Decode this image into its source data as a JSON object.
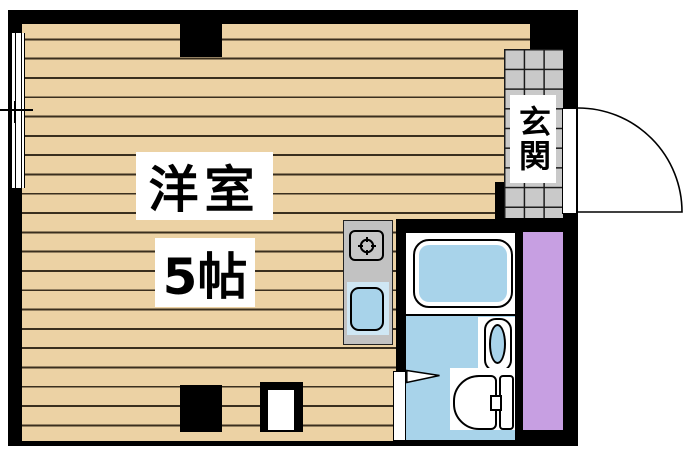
{
  "title": "apartment floor plan",
  "rooms": {
    "main_room": {
      "name": "洋室",
      "size": "5帖"
    },
    "entrance": {
      "name": "玄関"
    }
  },
  "fixtures": {
    "kitchen": [
      "stove",
      "kitchen-sink"
    ],
    "bathroom": [
      "bathtub",
      "wash-basin",
      "toilet"
    ],
    "doors": [
      "entrance-swing-door",
      "bathroom-door"
    ],
    "other": [
      "window",
      "closet-strip",
      "pillars"
    ]
  },
  "colors": {
    "wall": "#000000",
    "wood": "#ecd2a4",
    "tile": "#c9c9c9",
    "water_blue": "#a8d3ea",
    "kitchen_gray": "#c2c2c2",
    "closet_purple": "#c79fe2"
  }
}
